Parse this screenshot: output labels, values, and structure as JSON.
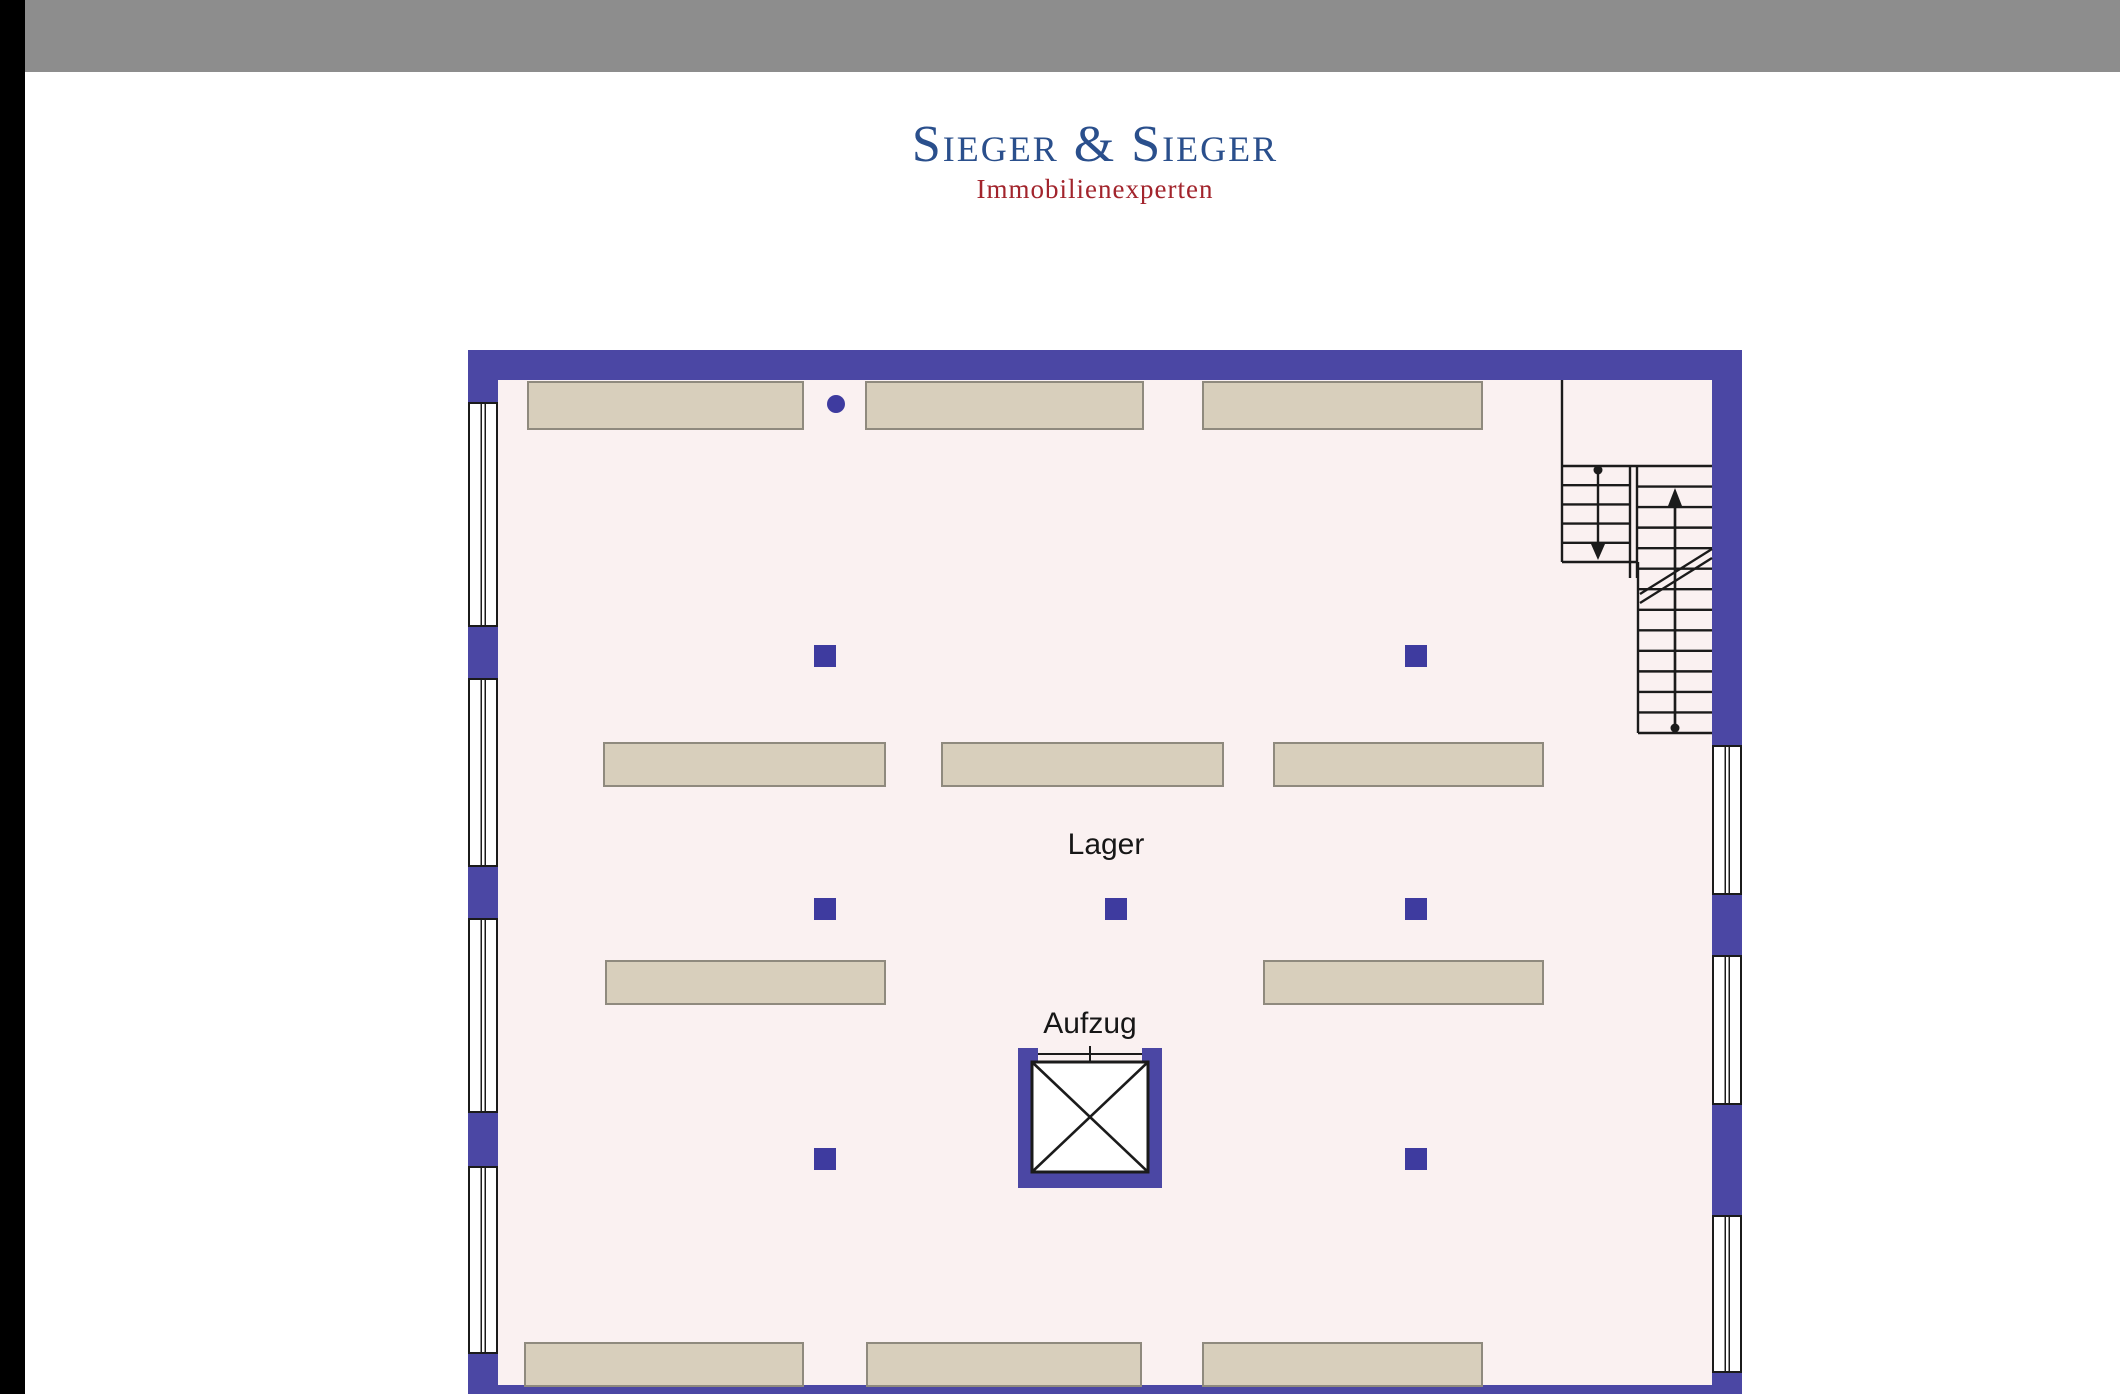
{
  "header": {
    "bar_color": "#8d8d8d",
    "edge_strip_color": "#000000"
  },
  "logo": {
    "name": "Sieger & Sieger",
    "tagline": "Immobilienexperten",
    "name_color": "#2a4f8c",
    "tagline_color": "#a2242c"
  },
  "plan": {
    "labels": {
      "storage": "Lager",
      "elevator": "Aufzug"
    },
    "colors": {
      "wall": "#4b47a4",
      "floor": "#faf1f1",
      "outline": "#2b2b66",
      "shelf": "#d8cfbc",
      "shelf_border": "#8f8a7e",
      "column": "#3e3b9f",
      "line": "#1b1b1b"
    },
    "walls": [
      {
        "x": 468,
        "y": 350,
        "w": 1274,
        "h": 30
      },
      {
        "x": 468,
        "y": 380,
        "w": 30,
        "h": 22
      },
      {
        "x": 468,
        "y": 627,
        "w": 30,
        "h": 51
      },
      {
        "x": 468,
        "y": 867,
        "w": 30,
        "h": 51
      },
      {
        "x": 468,
        "y": 1113,
        "w": 30,
        "h": 53
      },
      {
        "x": 468,
        "y": 1354,
        "w": 30,
        "h": 40
      },
      {
        "x": 1712,
        "y": 380,
        "w": 30,
        "h": 365
      },
      {
        "x": 1712,
        "y": 895,
        "w": 30,
        "h": 60
      },
      {
        "x": 1712,
        "y": 1105,
        "w": 30,
        "h": 110
      },
      {
        "x": 1712,
        "y": 1373,
        "w": 30,
        "h": 21
      },
      {
        "x": 468,
        "y": 1385,
        "w": 1274,
        "h": 9
      },
      {
        "x": 1018,
        "y": 1048,
        "w": 20,
        "h": 140
      },
      {
        "x": 1142,
        "y": 1048,
        "w": 20,
        "h": 140
      },
      {
        "x": 1018,
        "y": 1168,
        "w": 144,
        "h": 20
      }
    ],
    "windows": [
      {
        "x": 468,
        "y": 402,
        "w": 30,
        "h": 225
      },
      {
        "x": 468,
        "y": 678,
        "w": 30,
        "h": 189
      },
      {
        "x": 468,
        "y": 918,
        "w": 30,
        "h": 195
      },
      {
        "x": 468,
        "y": 1166,
        "w": 30,
        "h": 188
      },
      {
        "x": 1712,
        "y": 745,
        "w": 30,
        "h": 150
      },
      {
        "x": 1712,
        "y": 955,
        "w": 30,
        "h": 150
      },
      {
        "x": 1712,
        "y": 1215,
        "w": 30,
        "h": 158
      }
    ],
    "shelves": [
      {
        "x": 527,
        "y": 381,
        "w": 277,
        "h": 49
      },
      {
        "x": 865,
        "y": 381,
        "w": 279,
        "h": 49
      },
      {
        "x": 1202,
        "y": 381,
        "w": 281,
        "h": 49
      },
      {
        "x": 603,
        "y": 742,
        "w": 283,
        "h": 45
      },
      {
        "x": 941,
        "y": 742,
        "w": 283,
        "h": 45
      },
      {
        "x": 1273,
        "y": 742,
        "w": 271,
        "h": 45
      },
      {
        "x": 605,
        "y": 960,
        "w": 281,
        "h": 45
      },
      {
        "x": 1263,
        "y": 960,
        "w": 281,
        "h": 45
      },
      {
        "x": 524,
        "y": 1342,
        "w": 280,
        "h": 45
      },
      {
        "x": 866,
        "y": 1342,
        "w": 276,
        "h": 45
      },
      {
        "x": 1202,
        "y": 1342,
        "w": 281,
        "h": 45
      }
    ],
    "column_size": 22,
    "columns": [
      {
        "x": 814,
        "y": 645
      },
      {
        "x": 1405,
        "y": 645
      },
      {
        "x": 814,
        "y": 898
      },
      {
        "x": 1105,
        "y": 898
      },
      {
        "x": 1405,
        "y": 898
      },
      {
        "x": 814,
        "y": 1148
      },
      {
        "x": 1405,
        "y": 1148
      }
    ],
    "dot": {
      "cx": 836,
      "cy": 404,
      "r": 9
    },
    "label_positions": {
      "storage": {
        "x": 1106,
        "y": 845
      },
      "elevator": {
        "x": 1090,
        "y": 1024
      }
    },
    "stairs": {
      "room": {
        "left": 1562,
        "top": 380,
        "midX": 1638,
        "midY": 562,
        "right": 1712,
        "bottom": 733
      },
      "landingY": 466,
      "leftFlight": {
        "x1": 1562,
        "x2": 1630,
        "yTop": 466,
        "yBottom": 562,
        "treads": 4,
        "centerX": 1598
      },
      "rail": {
        "xA": 1630,
        "xB": 1637,
        "yTop": 466,
        "yBottom": 578
      },
      "rightFlight": {
        "x1": 1638,
        "x2": 1712,
        "yTop": 466,
        "yBottom": 733,
        "treads": 12,
        "centerX": 1675
      },
      "breakLine": {
        "x1": 1640,
        "y1": 594,
        "x2": 1712,
        "y2": 549,
        "offset": 9
      }
    },
    "elevator": {
      "inner": {
        "x": 1032,
        "y": 1062,
        "w": 116,
        "h": 110
      },
      "door": {
        "x1": 1038,
        "x2": 1142,
        "y": 1054
      },
      "tick": {
        "x": 1090,
        "y1": 1046,
        "y2": 1062
      }
    }
  }
}
